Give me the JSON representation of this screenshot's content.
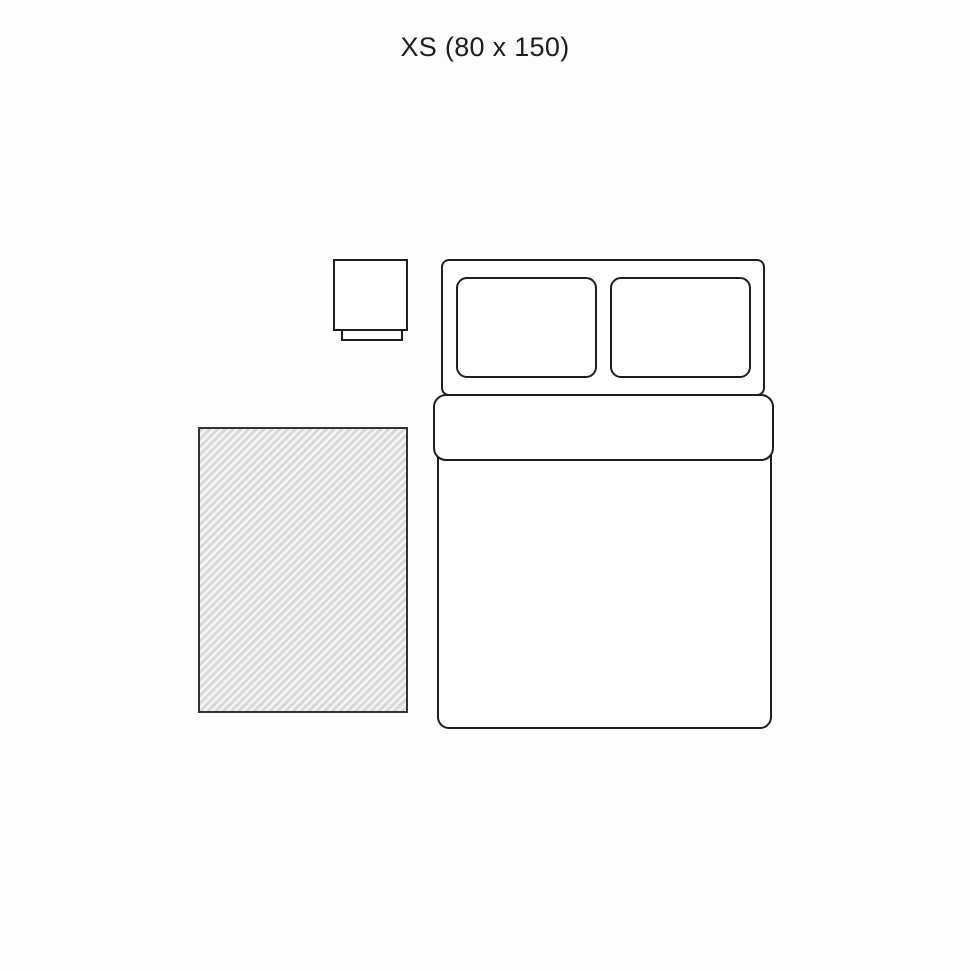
{
  "page": {
    "background": "#fdfdfd"
  },
  "title": {
    "text": "XS (80 x 150)",
    "size_code": "XS",
    "dimensions": "80 x 150"
  },
  "diagram": {
    "type": "rug-size-floorplan",
    "line_color": "#1e1e1e",
    "fill_color": "#ffffff",
    "rug": {
      "name": "rug",
      "pattern": "diagonal-hatch",
      "hatch_dark": "#d9d9d9",
      "hatch_light": "#f4f4f4",
      "border_color": "#333333"
    },
    "furniture": [
      {
        "name": "nightstand",
        "parts": [
          "top",
          "base"
        ]
      },
      {
        "name": "double-bed",
        "parts": [
          "headboard-area",
          "pillow-left",
          "pillow-right",
          "sheet-fold",
          "duvet"
        ]
      }
    ]
  }
}
